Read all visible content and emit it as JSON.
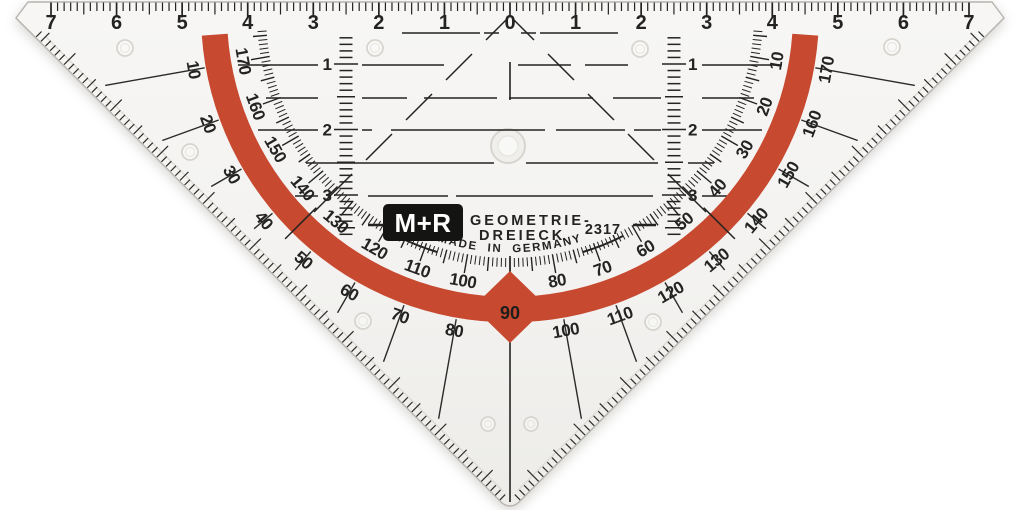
{
  "item": {
    "brand": "M+R",
    "product_line1": "GEOMETRIE-",
    "product_line2": "DREIECK",
    "model": "2317",
    "origin": "MADE IN GERMANY"
  },
  "ruler_cm": {
    "labels": [
      "7",
      "6",
      "5",
      "4",
      "3",
      "2",
      "1",
      "0",
      "1",
      "2",
      "3",
      "4",
      "5",
      "6",
      "7"
    ]
  },
  "vertical_cm_scales": {
    "labels": [
      "1",
      "2",
      "3"
    ]
  },
  "protractor": {
    "outer_scale": [
      "10",
      "20",
      "30",
      "40",
      "50",
      "60",
      "70",
      "80",
      "100",
      "110",
      "120",
      "130",
      "140",
      "150",
      "160",
      "170"
    ],
    "inner_scale": [
      "170",
      "160",
      "150",
      "140",
      "130",
      "120",
      "110",
      "100",
      "80",
      "70",
      "60",
      "50",
      "40",
      "30",
      "20",
      "10"
    ],
    "apex_label": "90"
  },
  "colors": {
    "arc_red": "#c7492f",
    "print_black": "#232321",
    "plastic_light": "#f5f4f2",
    "plastic_dark": "#eeedea",
    "mold_line": "#d8d5d0"
  }
}
